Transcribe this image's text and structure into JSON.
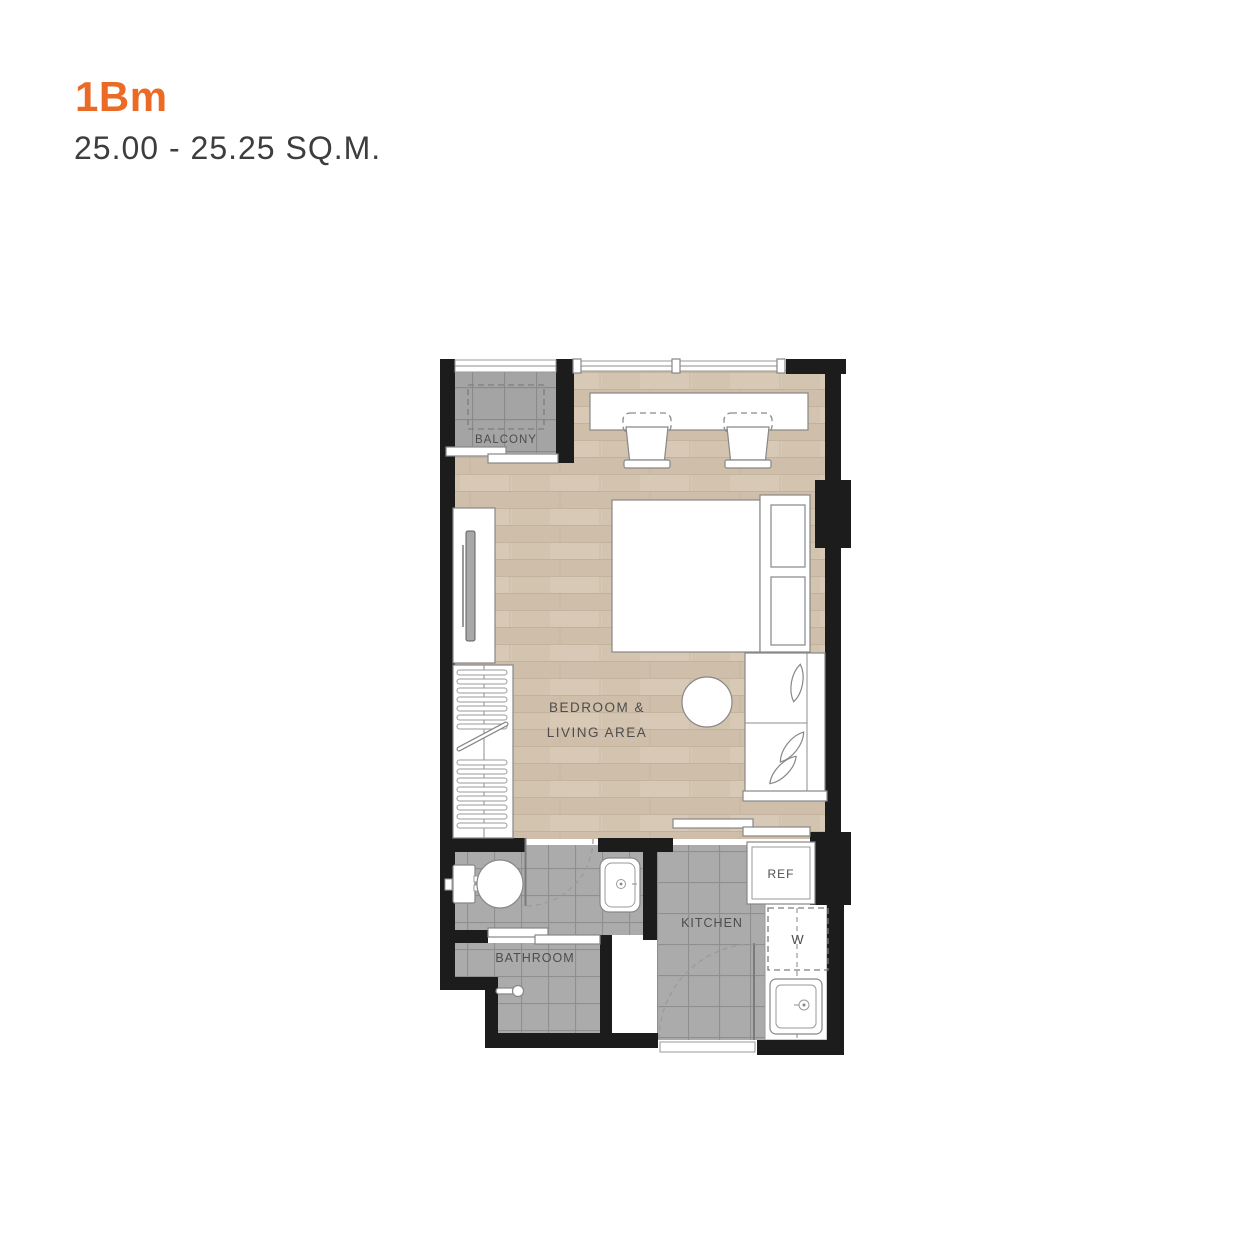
{
  "header": {
    "unit_type": "1Bm",
    "area_range": "25.00 - 25.25 SQ.M."
  },
  "floorplan": {
    "labels": {
      "balcony": "BALCONY",
      "bedroom_line1": "BEDROOM &",
      "bedroom_line2": "LIVING AREA",
      "bathroom": "BATHROOM",
      "kitchen": "KITCHEN",
      "refrigerator": "REF",
      "washer": "W"
    },
    "colors": {
      "accent_orange": "#EA6A26",
      "wall": "#1c1c1c",
      "wood_floor": "#d2c3ae",
      "tile_gray": "#a9a9a9",
      "subtitle_text": "#3d3d3d",
      "label_text": "#4d4d4d"
    }
  }
}
